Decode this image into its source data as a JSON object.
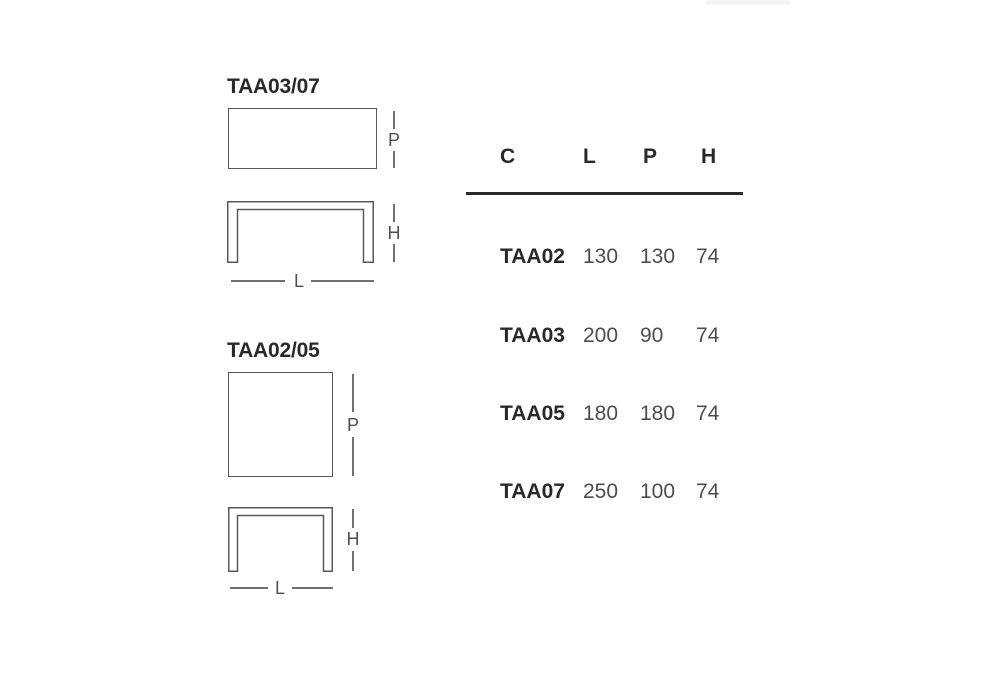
{
  "colors": {
    "background": "#ffffff",
    "text_dark": "#2b2829",
    "text_gray": "#4d4d4d",
    "line_gray": "#58595b",
    "dim_gray": "#707070",
    "dim_letter": "#4f4f4f",
    "artifact_gray": "#f3f3f3"
  },
  "diagrams": [
    {
      "title": "TAA03/07",
      "dim_labels": {
        "depth": "P",
        "height": "H",
        "length": "L"
      }
    },
    {
      "title": "TAA02/05",
      "dim_labels": {
        "depth": "P",
        "height": "H",
        "length": "L"
      }
    }
  ],
  "spec_table": {
    "columns": [
      "C",
      "L",
      "P",
      "H"
    ],
    "rows": [
      {
        "c": "TAA02",
        "l": "130",
        "p": "130",
        "h": "74"
      },
      {
        "c": "TAA03",
        "l": "200",
        "p": "90",
        "h": "74"
      },
      {
        "c": "TAA05",
        "l": "180",
        "p": "180",
        "h": "74"
      },
      {
        "c": "TAA07",
        "l": "250",
        "p": "100",
        "h": "74"
      }
    ]
  }
}
